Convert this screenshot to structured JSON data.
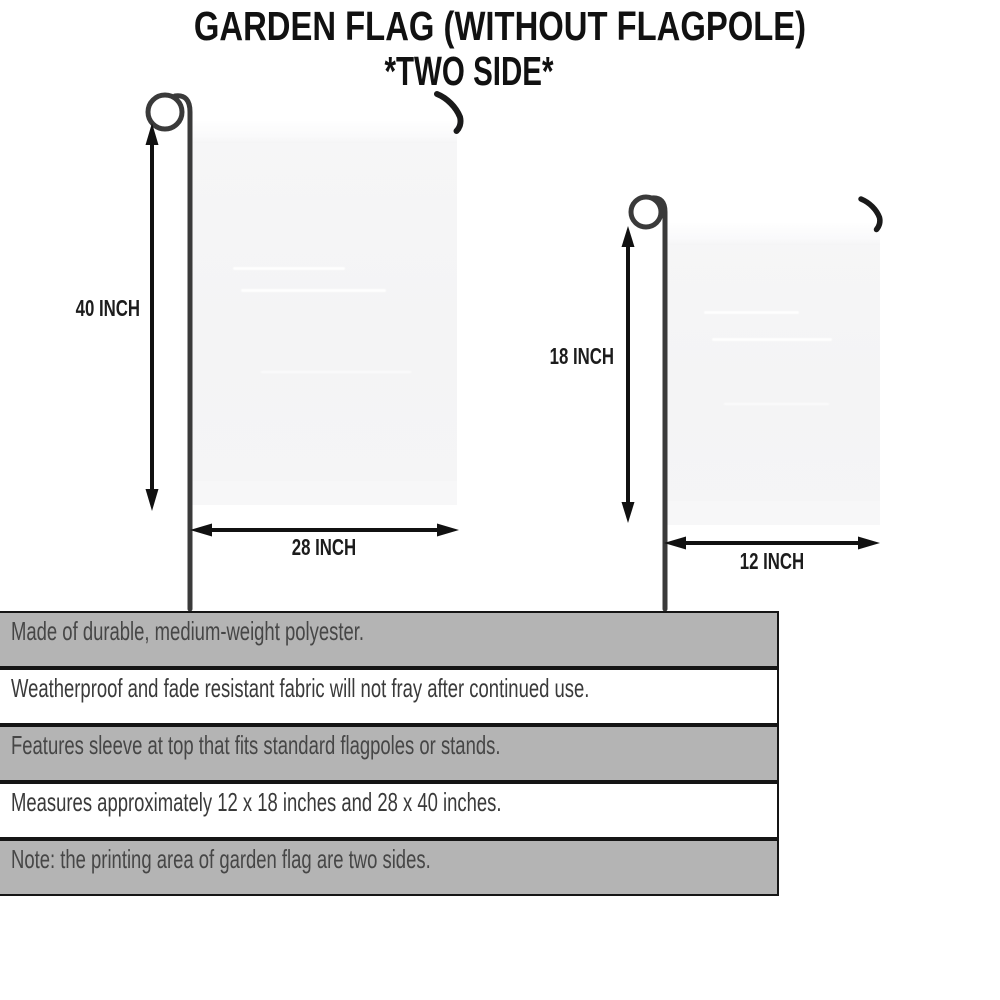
{
  "title": {
    "line1": "GARDEN FLAG (WITHOUT FLAGPOLE)",
    "line2": "*TWO SIDE*"
  },
  "flags": {
    "large": {
      "name": "large garden flag",
      "height_label": "40 INCH",
      "width_label": "28 INCH"
    },
    "small": {
      "name": "small garden flag",
      "height_label": "18 INCH",
      "width_label": "12 INCH"
    }
  },
  "specs": {
    "rows": [
      {
        "text": "Made of durable, medium-weight polyester."
      },
      {
        "text": "Weatherproof and fade resistant fabric will not fray after continued use."
      },
      {
        "text": "Features sleeve at top that fits standard flagpoles or stands."
      },
      {
        "text": "Measures approximately 12 x 18 inches and 28 x 40 inches."
      },
      {
        "text": "Note: the printing area of garden flag are two sides."
      }
    ]
  },
  "colors": {
    "row_gray": "#b4b4b4",
    "row_white": "#ffffff",
    "table_border": "#151515",
    "flag_fill": "#f4f4f5",
    "pole": "#3a3a3a",
    "hook": "#1a1a1a",
    "arrow": "#111111",
    "title_text": "#111111",
    "spec_text_gray_row": "#464646",
    "spec_text_white_row": "#3a3a3a"
  }
}
